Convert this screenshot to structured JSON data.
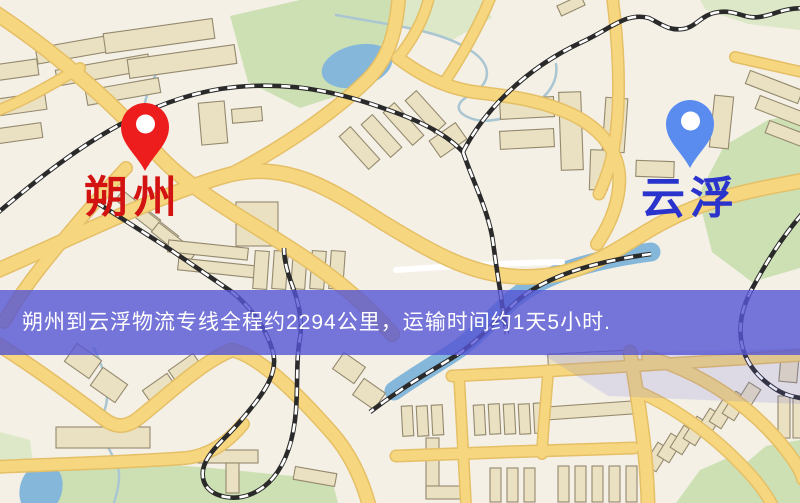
{
  "banner": {
    "text": "朔州到云浮物流专线全程约2294公里，运输时间约1天5小时.",
    "background_color": "#5555d5",
    "text_color": "#ffffff"
  },
  "origin": {
    "name": "朔州",
    "label_color": "#d31212",
    "pin_color": "#ee1d1d"
  },
  "destination": {
    "name": "云浮",
    "label_color": "#2a33cb",
    "pin_color": "#5a8cf0"
  },
  "route": {
    "origin": "朔州",
    "destination": "云浮",
    "distance_text": "约2294公里",
    "duration_text": "约1天5小时"
  },
  "map": {
    "palette": {
      "background": "#f4f0e6",
      "road_fill": "#f6d77f",
      "road_casing": "#e5bf66",
      "minor_road": "#ffffff",
      "building_fill": "#eae1c2",
      "building_stroke": "#94896e",
      "park": "#cde0b4",
      "park_light": "#dce8c8",
      "water": "#85b7da",
      "stream": "#a9c6d2",
      "railway_dark": "#2a2a2a",
      "railway_light": "#ffffff"
    }
  }
}
